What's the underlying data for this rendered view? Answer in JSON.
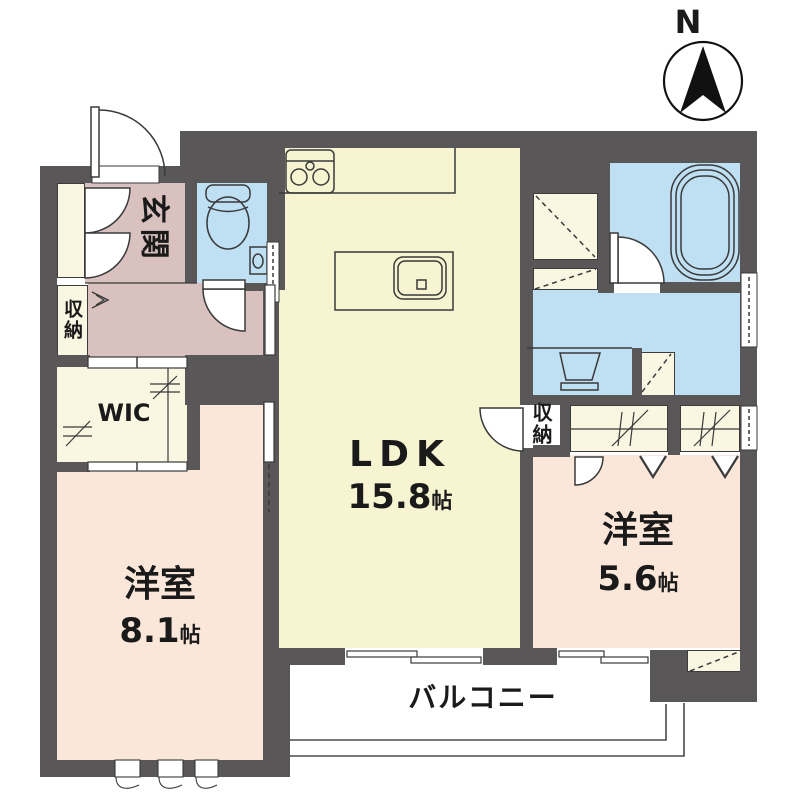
{
  "plan": {
    "compass_label": "N",
    "rooms": {
      "genkan": {
        "name": "玄関"
      },
      "storage_left": {
        "name": "収納"
      },
      "wic": {
        "name": "WIC"
      },
      "ldk": {
        "name": "LDK",
        "size_value": "15.8",
        "size_unit": "帖"
      },
      "bedroom_west": {
        "name": "洋室",
        "size_value": "8.1",
        "size_unit": "帖"
      },
      "bedroom_east": {
        "name": "洋室",
        "size_value": "5.6",
        "size_unit": "帖"
      },
      "storage_right": {
        "name": "収納"
      },
      "balcony": {
        "name": "バルコニー"
      }
    },
    "colors": {
      "wall": "#595757",
      "ldk_floor": "#f7f4d1",
      "bedroom_floor": "#fbe7d9",
      "hall_floor": "#d9c1c0",
      "wet_area_floor": "#bfdff2",
      "closet_floor": "#f9f6e2"
    }
  }
}
